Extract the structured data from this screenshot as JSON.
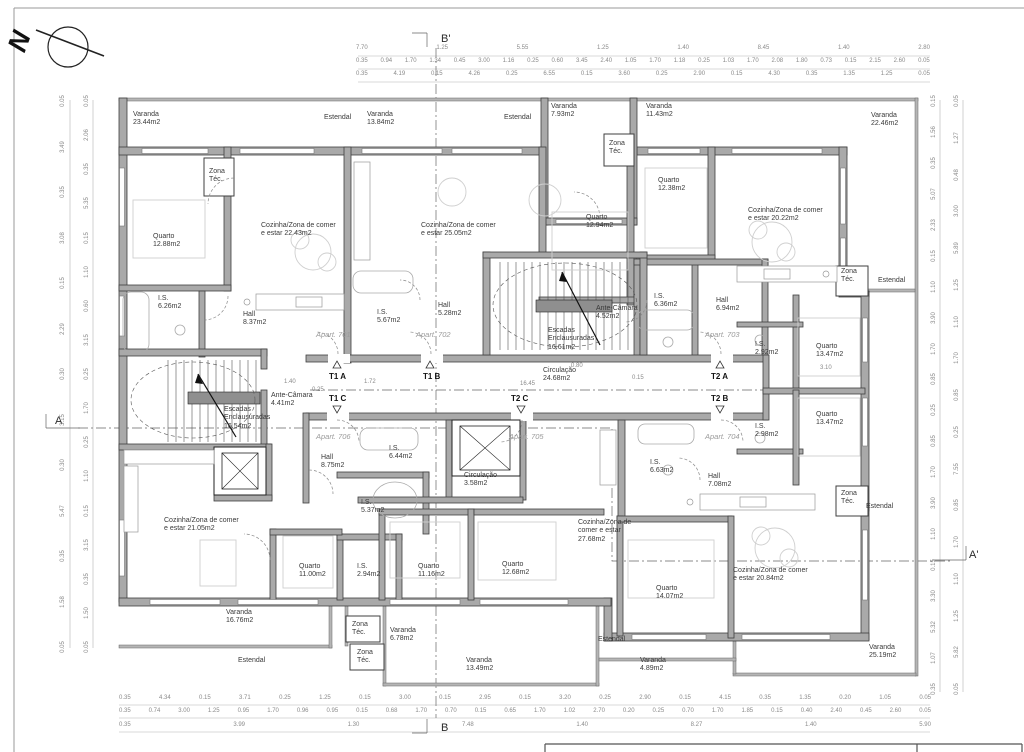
{
  "north": {
    "label": "N"
  },
  "labels": [
    {
      "t": "Varanda 23.44m2",
      "x": 133,
      "y": 111,
      "w": 46,
      "cls": "room"
    },
    {
      "t": "Estendal",
      "x": 324,
      "y": 114,
      "w": 44,
      "cls": "room"
    },
    {
      "t": "Varanda 13.84m2",
      "x": 367,
      "y": 111,
      "w": 46,
      "cls": "room"
    },
    {
      "t": "Estendal",
      "x": 504,
      "y": 114,
      "w": 44,
      "cls": "room"
    },
    {
      "t": "Varanda 7.93m2",
      "x": 551,
      "y": 103,
      "w": 46,
      "cls": "room"
    },
    {
      "t": "Varanda 11.43m2",
      "x": 646,
      "y": 103,
      "w": 46,
      "cls": "room"
    },
    {
      "t": "Varanda 22.46m2",
      "x": 871,
      "y": 112,
      "w": 46,
      "cls": "room"
    },
    {
      "t": "Zona Téc.",
      "x": 209,
      "y": 168,
      "w": 26,
      "cls": "room"
    },
    {
      "t": "Quarto 12.88m2",
      "x": 153,
      "y": 233,
      "w": 44,
      "cls": "room"
    },
    {
      "t": "Cozinha/Zona de comer e estar 22.43m2",
      "x": 261,
      "y": 222,
      "w": 78,
      "cls": "room"
    },
    {
      "t": "I.S. 6.26m2",
      "x": 158,
      "y": 295,
      "w": 30,
      "cls": "room"
    },
    {
      "t": "Hall 8.37m2",
      "x": 243,
      "y": 311,
      "w": 30,
      "cls": "room"
    },
    {
      "t": "Cozinha/Zona de comer e estar 25.05m2",
      "x": 421,
      "y": 222,
      "w": 78,
      "cls": "room"
    },
    {
      "t": "I.S. 5.67m2",
      "x": 377,
      "y": 309,
      "w": 30,
      "cls": "room"
    },
    {
      "t": "Hall 5.28m2",
      "x": 438,
      "y": 302,
      "w": 30,
      "cls": "room"
    },
    {
      "t": "Zona Téc.",
      "x": 609,
      "y": 140,
      "w": 26,
      "cls": "room"
    },
    {
      "t": "Quarto 12.94m2",
      "x": 586,
      "y": 214,
      "w": 44,
      "cls": "room"
    },
    {
      "t": "Quarto 12.38m2",
      "x": 658,
      "y": 177,
      "w": 44,
      "cls": "room"
    },
    {
      "t": "Cozinha/Zona de comer e estar 20.22m2",
      "x": 748,
      "y": 207,
      "w": 80,
      "cls": "room"
    },
    {
      "t": "Ante-Câmara 4.52m2",
      "x": 596,
      "y": 305,
      "w": 60,
      "cls": "room"
    },
    {
      "t": "I.S. 6.36m2",
      "x": 654,
      "y": 293,
      "w": 30,
      "cls": "room"
    },
    {
      "t": "Hall 6.94m2",
      "x": 716,
      "y": 297,
      "w": 30,
      "cls": "room"
    },
    {
      "t": "I.S. 2.92m2",
      "x": 755,
      "y": 341,
      "w": 30,
      "cls": "room"
    },
    {
      "t": "Quarto 13.47m2",
      "x": 816,
      "y": 343,
      "w": 44,
      "cls": "room"
    },
    {
      "t": "Zona Téc.",
      "x": 841,
      "y": 268,
      "w": 26,
      "cls": "room"
    },
    {
      "t": "Estendal",
      "x": 878,
      "y": 277,
      "w": 44,
      "cls": "room"
    },
    {
      "t": "Escadas Enclausuradas 16.61m2",
      "x": 548,
      "y": 327,
      "w": 64,
      "cls": "room"
    },
    {
      "t": "Circulação 24.68m2",
      "x": 543,
      "y": 367,
      "w": 50,
      "cls": "room"
    },
    {
      "t": "Ante-Câmara 4.41m2",
      "x": 271,
      "y": 392,
      "w": 60,
      "cls": "room"
    },
    {
      "t": "Escadas Enclausuradas 16.54m2",
      "x": 224,
      "y": 406,
      "w": 64,
      "cls": "room"
    },
    {
      "t": "Hall 8.75m2",
      "x": 321,
      "y": 454,
      "w": 30,
      "cls": "room"
    },
    {
      "t": "I.S. 6.44m2",
      "x": 389,
      "y": 445,
      "w": 30,
      "cls": "room"
    },
    {
      "t": "I.S. 5.37m2",
      "x": 361,
      "y": 499,
      "w": 30,
      "cls": "room"
    },
    {
      "t": "I.S. 2.94m2",
      "x": 357,
      "y": 563,
      "w": 30,
      "cls": "room"
    },
    {
      "t": "Quarto 11.00m2",
      "x": 299,
      "y": 563,
      "w": 44,
      "cls": "room"
    },
    {
      "t": "Cozinha/Zona de comer e estar 21.05m2",
      "x": 164,
      "y": 517,
      "w": 78,
      "cls": "room"
    },
    {
      "t": "Circulação 3.58m2",
      "x": 464,
      "y": 472,
      "w": 50,
      "cls": "room"
    },
    {
      "t": "Quarto 11.16m2",
      "x": 418,
      "y": 563,
      "w": 44,
      "cls": "room"
    },
    {
      "t": "Quarto 12.68m2",
      "x": 502,
      "y": 561,
      "w": 44,
      "cls": "room"
    },
    {
      "t": "Cozinha/Zona de comer e estar 27.68m2",
      "x": 578,
      "y": 519,
      "w": 62,
      "cls": "room"
    },
    {
      "t": "I.S. 6.63m2",
      "x": 650,
      "y": 459,
      "w": 30,
      "cls": "room"
    },
    {
      "t": "Hall 7.08m2",
      "x": 708,
      "y": 473,
      "w": 30,
      "cls": "room"
    },
    {
      "t": "I.S. 2.98m2",
      "x": 755,
      "y": 423,
      "w": 30,
      "cls": "room"
    },
    {
      "t": "Quarto 13.47m2",
      "x": 816,
      "y": 411,
      "w": 44,
      "cls": "room"
    },
    {
      "t": "Quarto 14.07m2",
      "x": 656,
      "y": 585,
      "w": 44,
      "cls": "room"
    },
    {
      "t": "Cozinha/Zona de comer e estar 20.84m2",
      "x": 733,
      "y": 567,
      "w": 80,
      "cls": "room"
    },
    {
      "t": "Zona Téc.",
      "x": 841,
      "y": 490,
      "w": 26,
      "cls": "room"
    },
    {
      "t": "Estendal",
      "x": 866,
      "y": 503,
      "w": 44,
      "cls": "room"
    },
    {
      "t": "Varanda 16.76m2",
      "x": 226,
      "y": 609,
      "w": 46,
      "cls": "room"
    },
    {
      "t": "Estendal",
      "x": 238,
      "y": 657,
      "w": 44,
      "cls": "room"
    },
    {
      "t": "Zona Téc.",
      "x": 352,
      "y": 621,
      "w": 26,
      "cls": "room"
    },
    {
      "t": "Zona Téc.",
      "x": 357,
      "y": 649,
      "w": 26,
      "cls": "room"
    },
    {
      "t": "Varanda 6.78m2",
      "x": 390,
      "y": 627,
      "w": 46,
      "cls": "room"
    },
    {
      "t": "Varanda 13.49m2",
      "x": 466,
      "y": 657,
      "w": 46,
      "cls": "room"
    },
    {
      "t": "Estendal",
      "x": 598,
      "y": 636,
      "w": 44,
      "cls": "room"
    },
    {
      "t": "Varanda 4.89m2",
      "x": 640,
      "y": 657,
      "w": 46,
      "cls": "room"
    },
    {
      "t": "Varanda 25.19m2",
      "x": 869,
      "y": 644,
      "w": 46,
      "cls": "room"
    },
    {
      "t": "Apart. 701",
      "x": 316,
      "y": 331,
      "cls": "apt"
    },
    {
      "t": "Apart. 702",
      "x": 416,
      "y": 331,
      "cls": "apt"
    },
    {
      "t": "Apart. 703",
      "x": 705,
      "y": 331,
      "cls": "apt"
    },
    {
      "t": "Apart. 704",
      "x": 705,
      "y": 433,
      "cls": "apt"
    },
    {
      "t": "Apart. 705",
      "x": 509,
      "y": 433,
      "cls": "apt"
    },
    {
      "t": "Apart. 706",
      "x": 316,
      "y": 433,
      "cls": "apt"
    },
    {
      "t": "T1 A",
      "x": 329,
      "y": 372,
      "cls": "type"
    },
    {
      "t": "T1 B",
      "x": 423,
      "y": 372,
      "cls": "type"
    },
    {
      "t": "T2 A",
      "x": 711,
      "y": 372,
      "cls": "type"
    },
    {
      "t": "T1 C",
      "x": 329,
      "y": 394,
      "cls": "type"
    },
    {
      "t": "T2 C",
      "x": 511,
      "y": 394,
      "cls": "type"
    },
    {
      "t": "T2 B",
      "x": 711,
      "y": 394,
      "cls": "type"
    },
    {
      "t": "16.45",
      "x": 520,
      "y": 381,
      "cls": "dim"
    },
    {
      "t": "0.25",
      "x": 312,
      "y": 387,
      "cls": "dim"
    },
    {
      "t": "1.40",
      "x": 284,
      "y": 379,
      "cls": "dim"
    },
    {
      "t": "1.72",
      "x": 364,
      "y": 379,
      "cls": "dim"
    },
    {
      "t": "0.80",
      "x": 571,
      "y": 363,
      "cls": "dim"
    },
    {
      "t": "0.15",
      "x": 632,
      "y": 375,
      "cls": "dim"
    },
    {
      "t": "3.10",
      "x": 820,
      "y": 365,
      "cls": "dim"
    },
    {
      "t": "B'",
      "x": 441,
      "y": 33,
      "cls": "marker"
    },
    {
      "t": "B",
      "x": 441,
      "y": 722,
      "cls": "marker"
    },
    {
      "t": "A",
      "x": 55,
      "y": 415,
      "cls": "marker"
    },
    {
      "t": "A'",
      "x": 969,
      "y": 549,
      "cls": "marker"
    }
  ],
  "dimensions": {
    "top_rows": [
      {
        "x": 356,
        "y": 45,
        "w": 574,
        "values": [
          "7.70",
          "1.25",
          "5.55",
          "1.25",
          "1.40",
          "8.45",
          "1.40",
          "2.80"
        ]
      },
      {
        "x": 356,
        "y": 58,
        "w": 574,
        "values": [
          "0.35",
          "0.94",
          "1.70",
          "1.34",
          "0.45",
          "3.00",
          "1.16",
          "0.25",
          "0.60",
          "3.45",
          "2.40",
          "1.05",
          "1.70",
          "1.18",
          "0.25",
          "1.03",
          "1.70",
          "2.08",
          "1.80",
          "0.73",
          "0.15",
          "2.15",
          "2.60",
          "0.05"
        ]
      },
      {
        "x": 356,
        "y": 71,
        "w": 574,
        "values": [
          "0.35",
          "4.19",
          "0.15",
          "4.26",
          "0.25",
          "6.55",
          "0.15",
          "3.60",
          "0.25",
          "2.90",
          "0.15",
          "4.30",
          "0.35",
          "1.35",
          "1.25",
          "0.05"
        ]
      }
    ],
    "bottom_rows": [
      {
        "x": 119,
        "y": 695,
        "w": 812,
        "values": [
          "0.35",
          "4.34",
          "0.15",
          "3.71",
          "0.25",
          "1.25",
          "0.15",
          "3.00",
          "0.15",
          "2.95",
          "0.15",
          "3.20",
          "0.25",
          "2.90",
          "0.15",
          "4.15",
          "0.35",
          "1.35",
          "0.20",
          "1.05",
          "0.05"
        ]
      },
      {
        "x": 119,
        "y": 708,
        "w": 812,
        "values": [
          "0.35",
          "0.74",
          "3.00",
          "1.25",
          "0.95",
          "1.70",
          "0.96",
          "0.95",
          "0.15",
          "0.68",
          "1.70",
          "0.70",
          "0.15",
          "0.65",
          "1.70",
          "1.02",
          "2.70",
          "0.20",
          "0.25",
          "0.70",
          "1.70",
          "1.85",
          "0.15",
          "0.40",
          "2.40",
          "0.45",
          "2.60",
          "0.05"
        ]
      },
      {
        "x": 119,
        "y": 722,
        "w": 812,
        "values": [
          "0.35",
          "3.99",
          "1.30",
          "7.48",
          "1.40",
          "8.27",
          "1.40",
          "5.90"
        ]
      }
    ],
    "left_cols": [
      {
        "x": 56,
        "y": 98,
        "h": 552,
        "values": [
          "0.05",
          "3.49",
          "0.35",
          "3.08",
          "0.15",
          "2.29",
          "0.30",
          "3.15",
          "0.30",
          "5.47",
          "0.35",
          "1.58",
          "0.05"
        ]
      },
      {
        "x": 80,
        "y": 98,
        "h": 552,
        "values": [
          "0.05",
          "2.06",
          "0.35",
          "5.35",
          "0.15",
          "1.10",
          "0.60",
          "3.15",
          "0.25",
          "1.70",
          "0.25",
          "1.10",
          "0.15",
          "3.15",
          "0.35",
          "1.50",
          "0.05"
        ]
      }
    ],
    "right_cols": [
      {
        "x": 927,
        "y": 98,
        "h": 594,
        "values": [
          "0.15",
          "1.56",
          "0.35",
          "5.07",
          "2.33",
          "0.15",
          "1.10",
          "3.90",
          "1.70",
          "0.85",
          "0.25",
          "0.85",
          "1.70",
          "3.90",
          "1.10",
          "0.15",
          "3.30",
          "5.32",
          "1.07",
          "0.35"
        ]
      },
      {
        "x": 950,
        "y": 98,
        "h": 594,
        "values": [
          "0.05",
          "1.27",
          "0.48",
          "3.00",
          "5.89",
          "1.25",
          "1.10",
          "1.70",
          "0.85",
          "0.25",
          "7.55",
          "0.85",
          "1.70",
          "1.10",
          "1.25",
          "5.82",
          "0.05"
        ]
      }
    ]
  }
}
